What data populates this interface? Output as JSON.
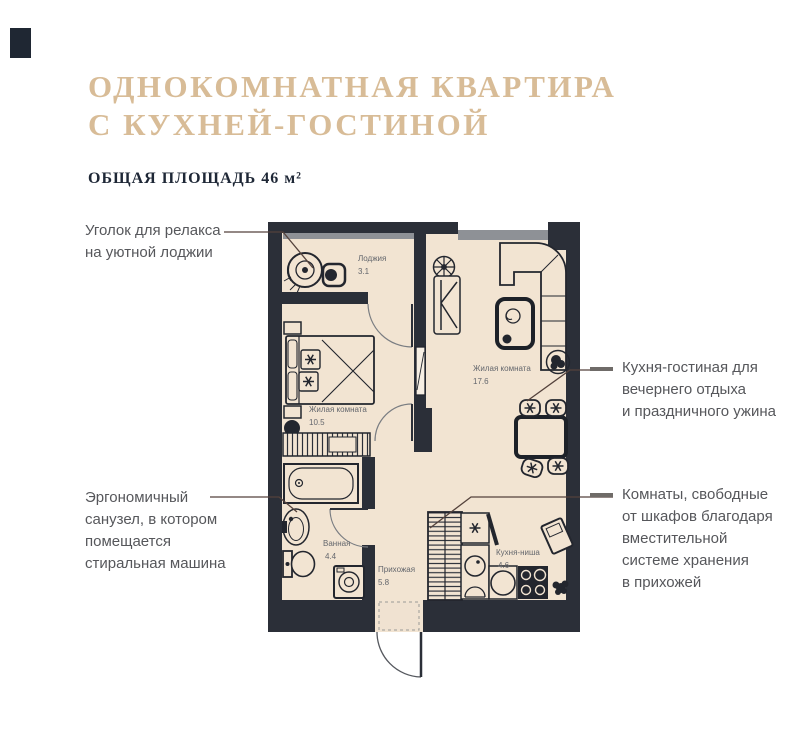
{
  "header": {
    "title_line1": "ОДНОКОМНАТНАЯ КВАРТИРА",
    "title_line2": "С КУХНЕЙ-ГОСТИНОЙ",
    "subtitle": "ОБЩАЯ ПЛОЩАДЬ 46 м²"
  },
  "callouts": [
    {
      "id": "loggia-relax",
      "lines": [
        "Уголок для релакса",
        "на уютной лоджии"
      ]
    },
    {
      "id": "kitchen-living",
      "lines": [
        "Кухня-гостиная для",
        "вечернего отдыха",
        "и праздничного ужина"
      ]
    },
    {
      "id": "bathroom",
      "lines": [
        "Эргономичный",
        "санузел, в котором",
        "помещается",
        "стиральная машина"
      ]
    },
    {
      "id": "storage",
      "lines": [
        "Комнаты, свободные",
        "от шкафов благодаря",
        "вместительной",
        "системе хранения",
        "в прихожей"
      ]
    }
  ],
  "floor_plan": {
    "rooms": [
      {
        "name": "Лоджия",
        "area": "3.1"
      },
      {
        "name": "Жилая комната",
        "area": "17.6"
      },
      {
        "name": "Жилая комната",
        "area": "10.5"
      },
      {
        "name": "Ванная",
        "area": "4.4"
      },
      {
        "name": "Прихожая",
        "area": "5.8"
      },
      {
        "name": "Кухня-ниша",
        "area": "4.6"
      }
    ]
  },
  "colors": {
    "accent_gold": "#d8bc97",
    "wall_dark": "#2b2f38",
    "floor_cream": "#f2e4d2",
    "glazing_gray": "#8e9196",
    "callout_text_gray": "#56575b",
    "callout_line_brown": "#54423c",
    "logo_navy": "#1f2733"
  }
}
